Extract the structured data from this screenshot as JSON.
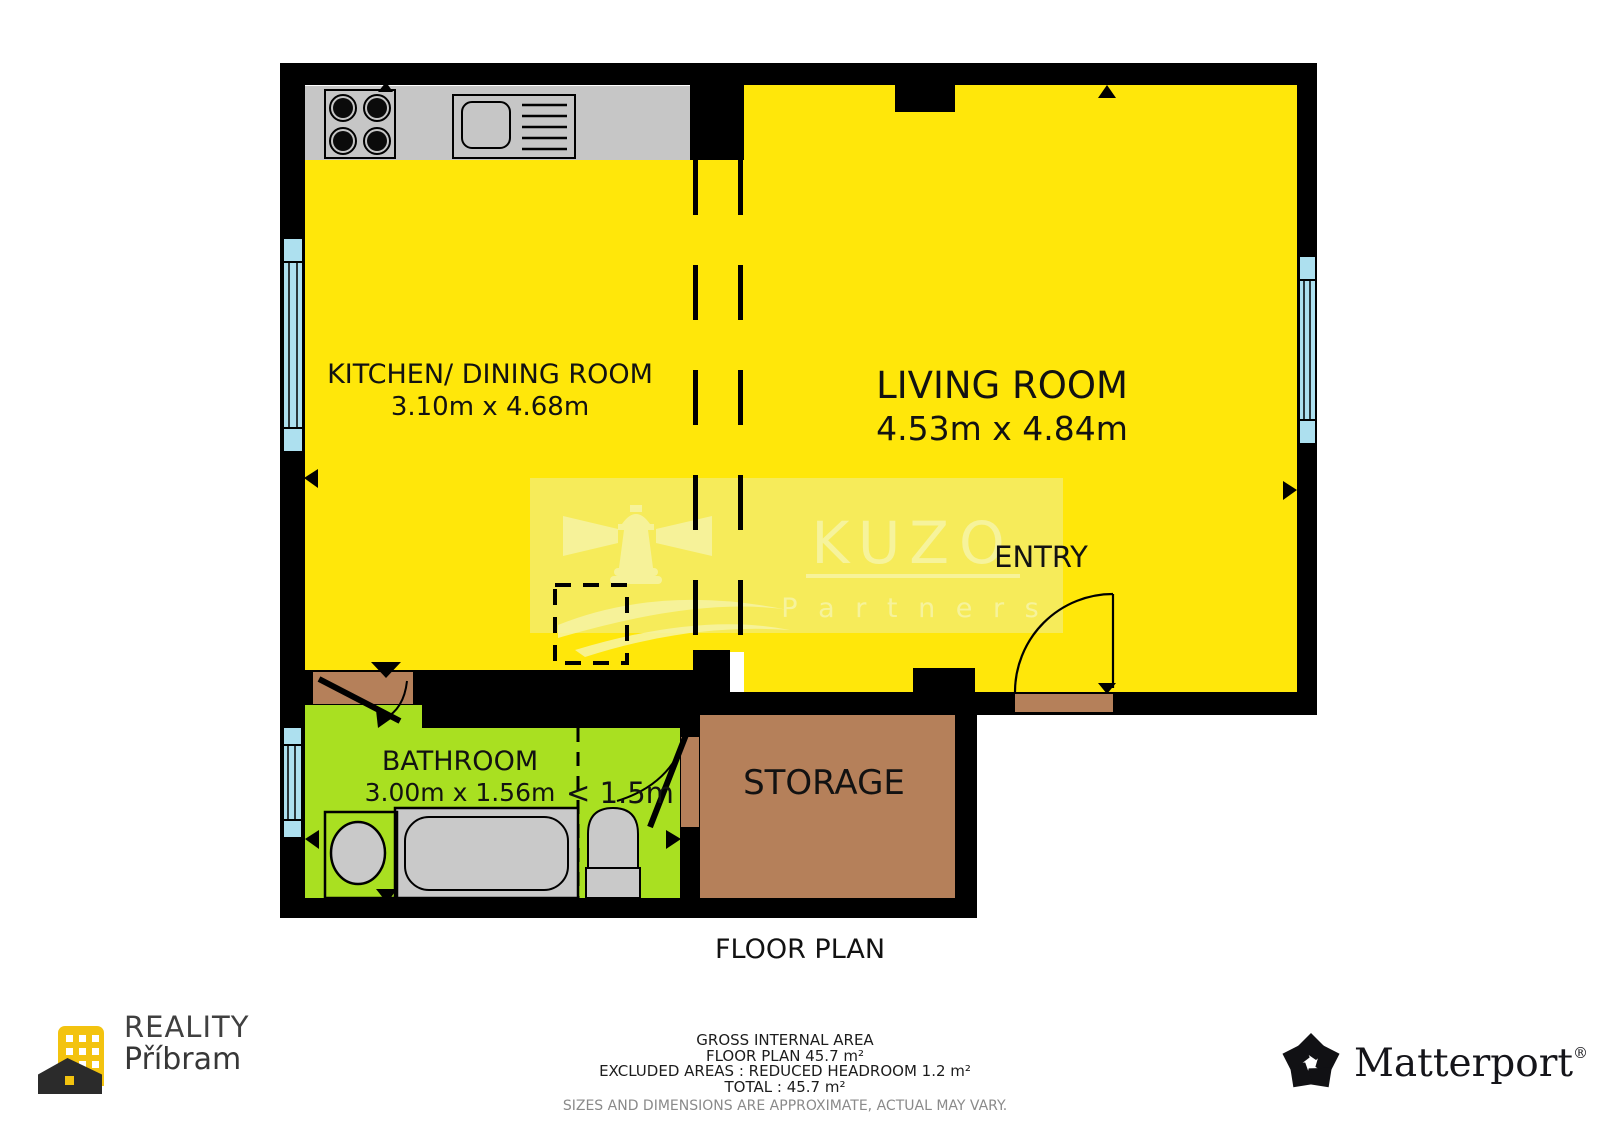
{
  "plan": {
    "caption": "FLOOR PLAN",
    "entry_label": "ENTRY",
    "reduced_headroom_label": "< 1.5m",
    "rooms": [
      {
        "name": "KITCHEN/ DINING ROOM",
        "dims": "3.10m x 4.68m",
        "floor_color": "#ffe70a"
      },
      {
        "name": "LIVING ROOM",
        "dims": "4.53m x 4.84m",
        "floor_color": "#ffe70a"
      },
      {
        "name": "BATHROOM",
        "dims": "3.00m x 1.56m",
        "floor_color": "#a9e021"
      },
      {
        "name": "STORAGE",
        "dims": "",
        "floor_color": "#b5805a"
      }
    ],
    "colors": {
      "wall": "#000000",
      "counter_gray": "#c6c6c6",
      "window_cyan": "#ade0ef",
      "door_brown": "#b5805a",
      "watermark_tint": "#f1ed8c"
    }
  },
  "area_summary": {
    "heading": "GROSS INTERNAL AREA",
    "floor_plan_line": "FLOOR PLAN 45.7 m²",
    "excluded_line": "EXCLUDED AREAS :  REDUCED HEADROOM 1.2 m²",
    "total_line": "TOTAL :  45.7 m²",
    "disclaimer": "SIZES AND DIMENSIONS ARE APPROXIMATE, ACTUAL MAY VARY."
  },
  "branding": {
    "agency": {
      "line1": "REALITY",
      "line2": "Příbram"
    },
    "watermark": {
      "line1": "KUZO",
      "line2": "P a r t n e r s"
    },
    "matterport": {
      "name": "Matterport",
      "registered": "®"
    }
  }
}
